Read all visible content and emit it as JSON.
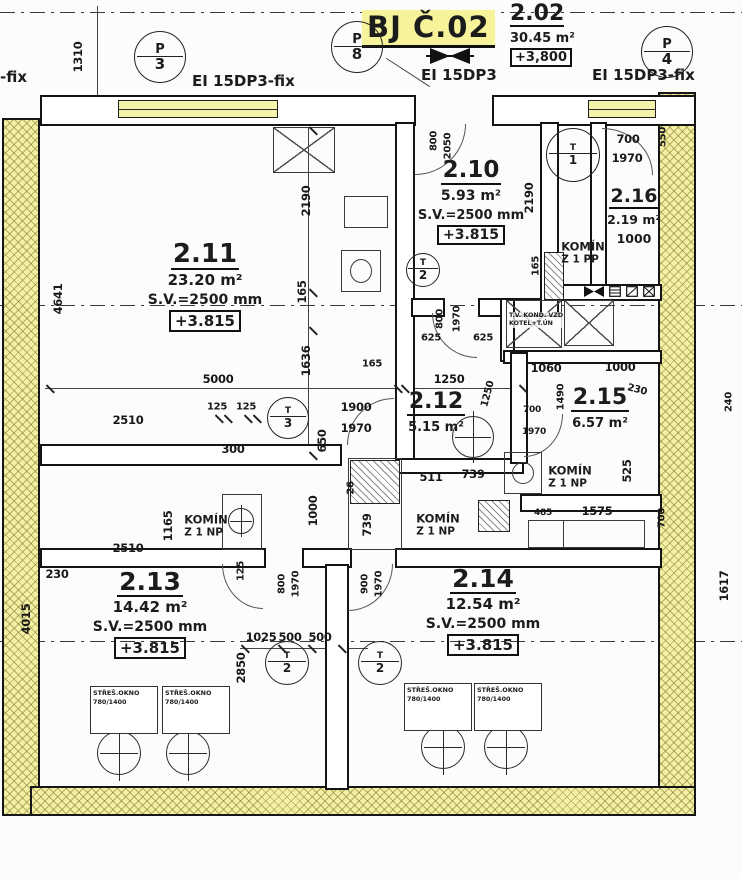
{
  "header": {
    "unit_title": "BJ Č.02",
    "apartment": {
      "number": "2.02",
      "area": "30.45 m²",
      "level": "+3,800"
    },
    "fire_ratings": {
      "left": "EI 15DP3-fix",
      "center": "EI 15DP3",
      "right": "EI 15DP3-fix",
      "edge_partial": "-fix"
    }
  },
  "rooms": {
    "r211": {
      "number": "2.11",
      "area": "23.20 m²",
      "ceiling": "S.V.=2500 mm",
      "level": "+3.815"
    },
    "r210": {
      "number": "2.10",
      "area": "5.93 m²",
      "ceiling": "S.V.=2500 mm",
      "level": "+3.815"
    },
    "r212": {
      "number": "2.12",
      "area": "5.15 m²"
    },
    "r213": {
      "number": "2.13",
      "area": "14.42 m²",
      "ceiling": "S.V.=2500 mm",
      "level": "+3.815"
    },
    "r214": {
      "number": "2.14",
      "area": "12.54 m²",
      "ceiling": "S.V.=2500 mm",
      "level": "+3.815"
    },
    "r215": {
      "number": "2.15",
      "area": "6.57 m²"
    },
    "r216": {
      "number": "2.16",
      "area": "2.19 m²",
      "width_dim": "1000"
    }
  },
  "chimneys": [
    {
      "line1": "KOMÍN",
      "line2": "Z 1 PP",
      "x": 583,
      "y": 253
    },
    {
      "line1": "KOMÍN",
      "line2": "Z 1 NP",
      "x": 570,
      "y": 477
    },
    {
      "line1": "KOMÍN",
      "line2": "Z 1 NP",
      "x": 206,
      "y": 526
    },
    {
      "line1": "KOMÍN",
      "line2": "Z 1 NP",
      "x": 438,
      "y": 525
    }
  ],
  "equipment": {
    "boiler_line1": "T.V. KOND. VZD",
    "boiler_line2": "KOTEL+T.ÚN",
    "roof_window": {
      "line1": "STŘEŠ.OKNO",
      "line2": "780/1400"
    },
    "roof_window_positions": [
      {
        "x": 90,
        "y": 686
      },
      {
        "x": 162,
        "y": 686
      },
      {
        "x": 404,
        "y": 683
      },
      {
        "x": 474,
        "y": 683
      }
    ]
  },
  "markers": {
    "grid": [
      {
        "letter": "P",
        "number": "3",
        "x": 160,
        "y": 57
      },
      {
        "letter": "P",
        "number": "8",
        "x": 357,
        "y": 47
      },
      {
        "letter": "P",
        "number": "4",
        "x": 667,
        "y": 52
      }
    ],
    "fixtures": [
      {
        "letter": "T",
        "number": "3",
        "x": 288,
        "y": 418,
        "r": 20
      },
      {
        "letter": "T",
        "number": "2",
        "x": 287,
        "y": 663,
        "r": 21
      },
      {
        "letter": "T",
        "number": "2",
        "x": 380,
        "y": 663,
        "r": 21
      },
      {
        "letter": "T",
        "number": "1",
        "x": 573,
        "y": 155,
        "r": 26
      },
      {
        "letter": "T",
        "number": "2",
        "x": 423,
        "y": 270,
        "r": 16
      }
    ],
    "lamps": [
      {
        "x": 119,
        "y": 753,
        "r": 21
      },
      {
        "x": 188,
        "y": 753,
        "r": 21
      },
      {
        "x": 443,
        "y": 747,
        "r": 21
      },
      {
        "x": 506,
        "y": 747,
        "r": 21
      },
      {
        "x": 473,
        "y": 437,
        "r": 20
      }
    ]
  },
  "dimensions": [
    {
      "t": "1310",
      "x": 78,
      "y": 57,
      "r": -90
    },
    {
      "t": "800",
      "x": 434,
      "y": 141,
      "r": -90,
      "s": 10
    },
    {
      "t": "2050",
      "x": 448,
      "y": 146,
      "r": -90,
      "s": 10
    },
    {
      "t": "700",
      "x": 628,
      "y": 139
    },
    {
      "t": "1970",
      "x": 627,
      "y": 158
    },
    {
      "t": "550",
      "x": 663,
      "y": 137,
      "r": -90,
      "s": 10
    },
    {
      "t": "2190",
      "x": 306,
      "y": 201,
      "r": -90
    },
    {
      "t": "2190",
      "x": 529,
      "y": 198,
      "r": -90
    },
    {
      "t": "165",
      "x": 302,
      "y": 292,
      "r": -90
    },
    {
      "t": "165",
      "x": 536,
      "y": 266,
      "r": -90,
      "s": 10
    },
    {
      "t": "1636",
      "x": 306,
      "y": 361,
      "r": -90
    },
    {
      "t": "625",
      "x": 431,
      "y": 338,
      "s": 10
    },
    {
      "t": "625",
      "x": 483,
      "y": 338,
      "s": 10
    },
    {
      "t": "800",
      "x": 440,
      "y": 319,
      "r": -90,
      "s": 10
    },
    {
      "t": "1970",
      "x": 457,
      "y": 319,
      "r": -90,
      "s": 10
    },
    {
      "t": "5000",
      "x": 218,
      "y": 379
    },
    {
      "t": "165",
      "x": 372,
      "y": 364,
      "s": 10
    },
    {
      "t": "1250",
      "x": 449,
      "y": 379
    },
    {
      "t": "1250",
      "x": 488,
      "y": 394,
      "r": -75,
      "s": 10
    },
    {
      "t": "1060",
      "x": 546,
      "y": 368
    },
    {
      "t": "1000",
      "x": 620,
      "y": 367
    },
    {
      "t": "1490",
      "x": 561,
      "y": 397,
      "r": -90,
      "s": 10
    },
    {
      "t": "230",
      "x": 637,
      "y": 390,
      "r": 15,
      "s": 10
    },
    {
      "t": "2510",
      "x": 128,
      "y": 420
    },
    {
      "t": "125",
      "x": 217,
      "y": 407,
      "s": 10
    },
    {
      "t": "125",
      "x": 246,
      "y": 407,
      "s": 10
    },
    {
      "t": "1900",
      "x": 356,
      "y": 407
    },
    {
      "t": "1970",
      "x": 356,
      "y": 428
    },
    {
      "t": "700",
      "x": 532,
      "y": 410,
      "s": 9
    },
    {
      "t": "1970",
      "x": 534,
      "y": 432,
      "s": 9
    },
    {
      "t": "300",
      "x": 233,
      "y": 449
    },
    {
      "t": "650",
      "x": 322,
      "y": 441,
      "r": -90
    },
    {
      "t": "511",
      "x": 431,
      "y": 477
    },
    {
      "t": "739",
      "x": 473,
      "y": 474
    },
    {
      "t": "26",
      "x": 351,
      "y": 488,
      "r": -90,
      "s": 10
    },
    {
      "t": "739",
      "x": 367,
      "y": 525,
      "r": -90
    },
    {
      "t": "1000",
      "x": 313,
      "y": 511,
      "r": -90
    },
    {
      "t": "525",
      "x": 627,
      "y": 471,
      "r": -90
    },
    {
      "t": "485",
      "x": 543,
      "y": 513,
      "s": 9
    },
    {
      "t": "1575",
      "x": 597,
      "y": 511
    },
    {
      "t": "700",
      "x": 662,
      "y": 518,
      "r": -90,
      "s": 10
    },
    {
      "t": "1165",
      "x": 168,
      "y": 526,
      "r": -90
    },
    {
      "t": "2510",
      "x": 128,
      "y": 548
    },
    {
      "t": "125",
      "x": 241,
      "y": 571,
      "r": -90,
      "s": 10
    },
    {
      "t": "800",
      "x": 282,
      "y": 584,
      "r": -90,
      "s": 10
    },
    {
      "t": "1970",
      "x": 296,
      "y": 584,
      "r": -90,
      "s": 10
    },
    {
      "t": "900",
      "x": 365,
      "y": 584,
      "r": -90,
      "s": 10
    },
    {
      "t": "1970",
      "x": 379,
      "y": 584,
      "r": -90,
      "s": 10
    },
    {
      "t": "4641",
      "x": 58,
      "y": 299,
      "r": -90
    },
    {
      "t": "230",
      "x": 57,
      "y": 574
    },
    {
      "t": "4015",
      "x": 26,
      "y": 619,
      "r": -90
    },
    {
      "t": "240",
      "x": 729,
      "y": 402,
      "r": -90,
      "s": 10
    },
    {
      "t": "1617",
      "x": 724,
      "y": 586,
      "r": -90
    },
    {
      "t": "2850",
      "x": 241,
      "y": 668,
      "r": -90
    },
    {
      "t": "1025",
      "x": 261,
      "y": 637
    },
    {
      "t": "500",
      "x": 290,
      "y": 637
    },
    {
      "t": "500",
      "x": 320,
      "y": 637
    }
  ],
  "colors": {
    "wall_hatch": "#f4f0a3",
    "title_highlight": "#f6f39b",
    "ink": "#1c1c1c"
  }
}
